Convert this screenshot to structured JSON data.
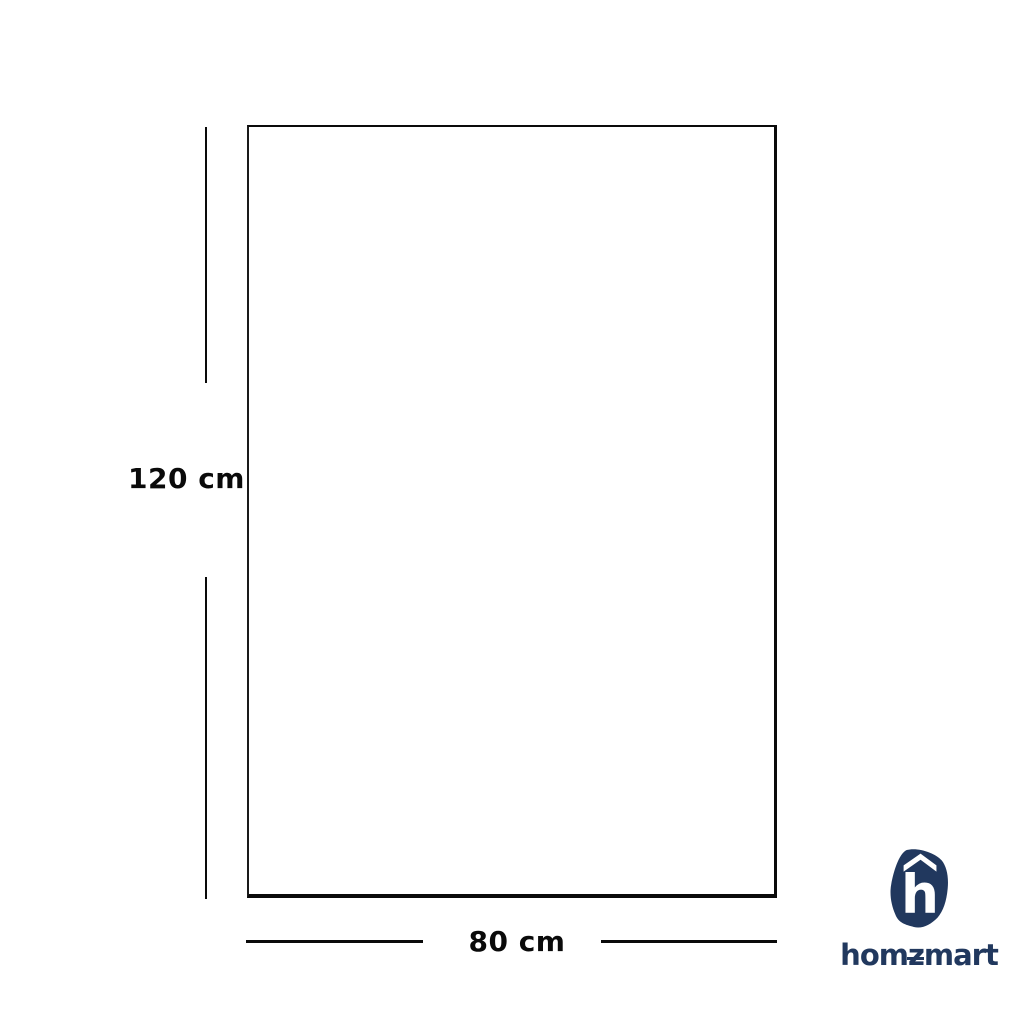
{
  "page": {
    "background": "#ffffff"
  },
  "colors": {
    "line_black": "#0a0a0a",
    "brand_navy": "#21385e",
    "logo_glyph_white": "#ffffff"
  },
  "diagram": {
    "height_label": "120 cm",
    "width_label": "80 cm"
  },
  "brand": {
    "logo_letter": "h",
    "wordmark_pre": "hom",
    "wordmark_z": "z",
    "wordmark_post": "mart",
    "wordmark_full": "homzmart"
  }
}
